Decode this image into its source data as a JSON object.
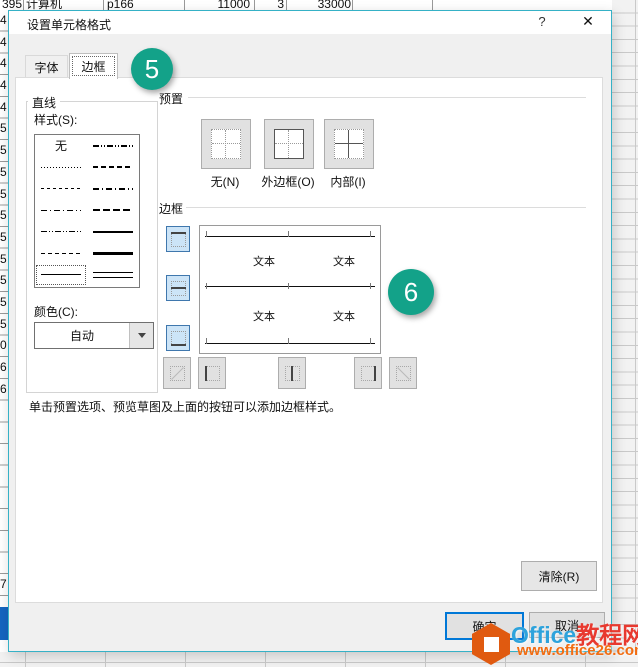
{
  "sheet": {
    "top_row": {
      "cells": [
        "395",
        "计算机",
        "p166",
        "11000",
        "3",
        "33000"
      ]
    },
    "left_digits": [
      "4",
      "4",
      "4",
      "4",
      "4",
      "5",
      "5",
      "5",
      "5",
      "5",
      "5",
      "5",
      "5",
      "5",
      "5",
      "0",
      "6",
      "6",
      "",
      "",
      "",
      "",
      "",
      "",
      "",
      "",
      "7",
      ""
    ]
  },
  "titlebar": {
    "title": "设置单元格格式",
    "help": "?",
    "close": "✕"
  },
  "tabs": {
    "font": "字体",
    "border": "边框"
  },
  "line": {
    "group_title": "直线",
    "style_label": "样式(S):",
    "none_option": "无",
    "styles_left": [
      "none",
      "dotted-fine",
      "dash-small",
      "dash-dot",
      "dash-dot-dot",
      "dash-fine",
      "solid-thin"
    ],
    "styles_right": [
      "medium-dash-dot-dot",
      "medium-dash",
      "medium-dash-dot",
      "medium-dash-long",
      "solid-medium",
      "solid-thick",
      "double"
    ],
    "selected_style": "solid-thin",
    "color_label": "颜色(C):",
    "color_value": "自动"
  },
  "presets": {
    "group_title": "预置",
    "none_label": "无(N)",
    "outline_label": "外边框(O)",
    "inside_label": "内部(I)"
  },
  "border": {
    "group_title": "边框",
    "text_label": "文本",
    "active_edges": [
      "top",
      "middle-horizontal",
      "bottom"
    ]
  },
  "hint": {
    "text": "单击预置选项、预览草图及上面的按钮可以添加边框样式。"
  },
  "actions": {
    "clear": "清除(R)",
    "ok": "确定",
    "cancel": "取消"
  },
  "annotations": {
    "step_5": "5",
    "step_6": "6"
  },
  "watermark": {
    "brand": "Office",
    "brand_cn": "教程网",
    "url": "www.office26.com"
  },
  "colors": {
    "dialog_border": "#35b1c6",
    "annotation_badge": "#13a289",
    "toggle_active_bg": "#cce4f7",
    "toggle_active_border": "#3f77ad",
    "default_button_border": "#0078d7",
    "selection_block": "#1565c0",
    "watermark_blue": "#2ea3dc",
    "watermark_red": "#e8392f",
    "watermark_orange": "#f26c11"
  }
}
